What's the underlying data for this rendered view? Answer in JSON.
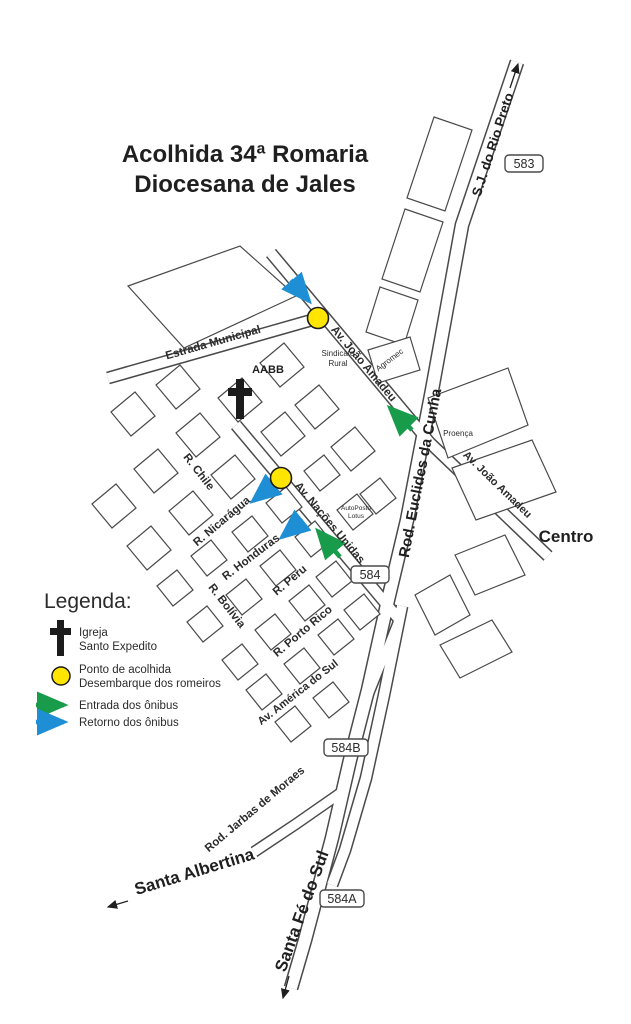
{
  "title": {
    "line1": "Acolhida 34ª Romaria",
    "line2": "Diocesana de Jales"
  },
  "legend": {
    "heading": "Legenda:",
    "church": {
      "line1": "Igreja",
      "line2": "Santo Expedito"
    },
    "pickup": {
      "line1": "Ponto de acolhida",
      "line2": "Desembarque dos romeiros"
    },
    "entry": "Entrada dos ônibus",
    "return": "Retorno dos ônibus"
  },
  "roads": {
    "euclides_da_cunha": "Rod. Euclides da Cunha",
    "jarbas_de_moraes": "Rod. Jarbas de Moraes",
    "estrada_municipal": "Estrada Municipal",
    "joao_amadeu": "Av. João Amadeu",
    "nacoes_unidas": "Av. Nações Unidas",
    "america_do_sul": "Av. América do Sul",
    "nicaragua": "R. Nicarágua",
    "honduras": "R. Honduras",
    "peru": "R. Peru",
    "chile": "R. Chile",
    "bolivia": "R. Bolívia",
    "porto_rico": "R. Porto Rico"
  },
  "destinations": {
    "sj_rio_preto": "S.J. do Rio Preto",
    "santa_albertina": "Santa Albertina",
    "santa_fe_do_sul": "Santa Fé do Sul",
    "centro": "Centro"
  },
  "shields": {
    "n583": "583",
    "n584": "584",
    "n584b": "584B",
    "n584a": "584A"
  },
  "places": {
    "aabb": "AABB",
    "sindicato": {
      "line1": "Sindicato",
      "line2": "Rural"
    },
    "agromec": "Agromec",
    "proenca": "Proença",
    "autoposto": {
      "line1": "AutoPosto",
      "line2": "Lotus"
    }
  },
  "colors": {
    "outline": "#4A4A4A",
    "pickup_yellow": "#FFE500",
    "entry_green": "#189B4A",
    "return_blue": "#1E8FD4"
  }
}
